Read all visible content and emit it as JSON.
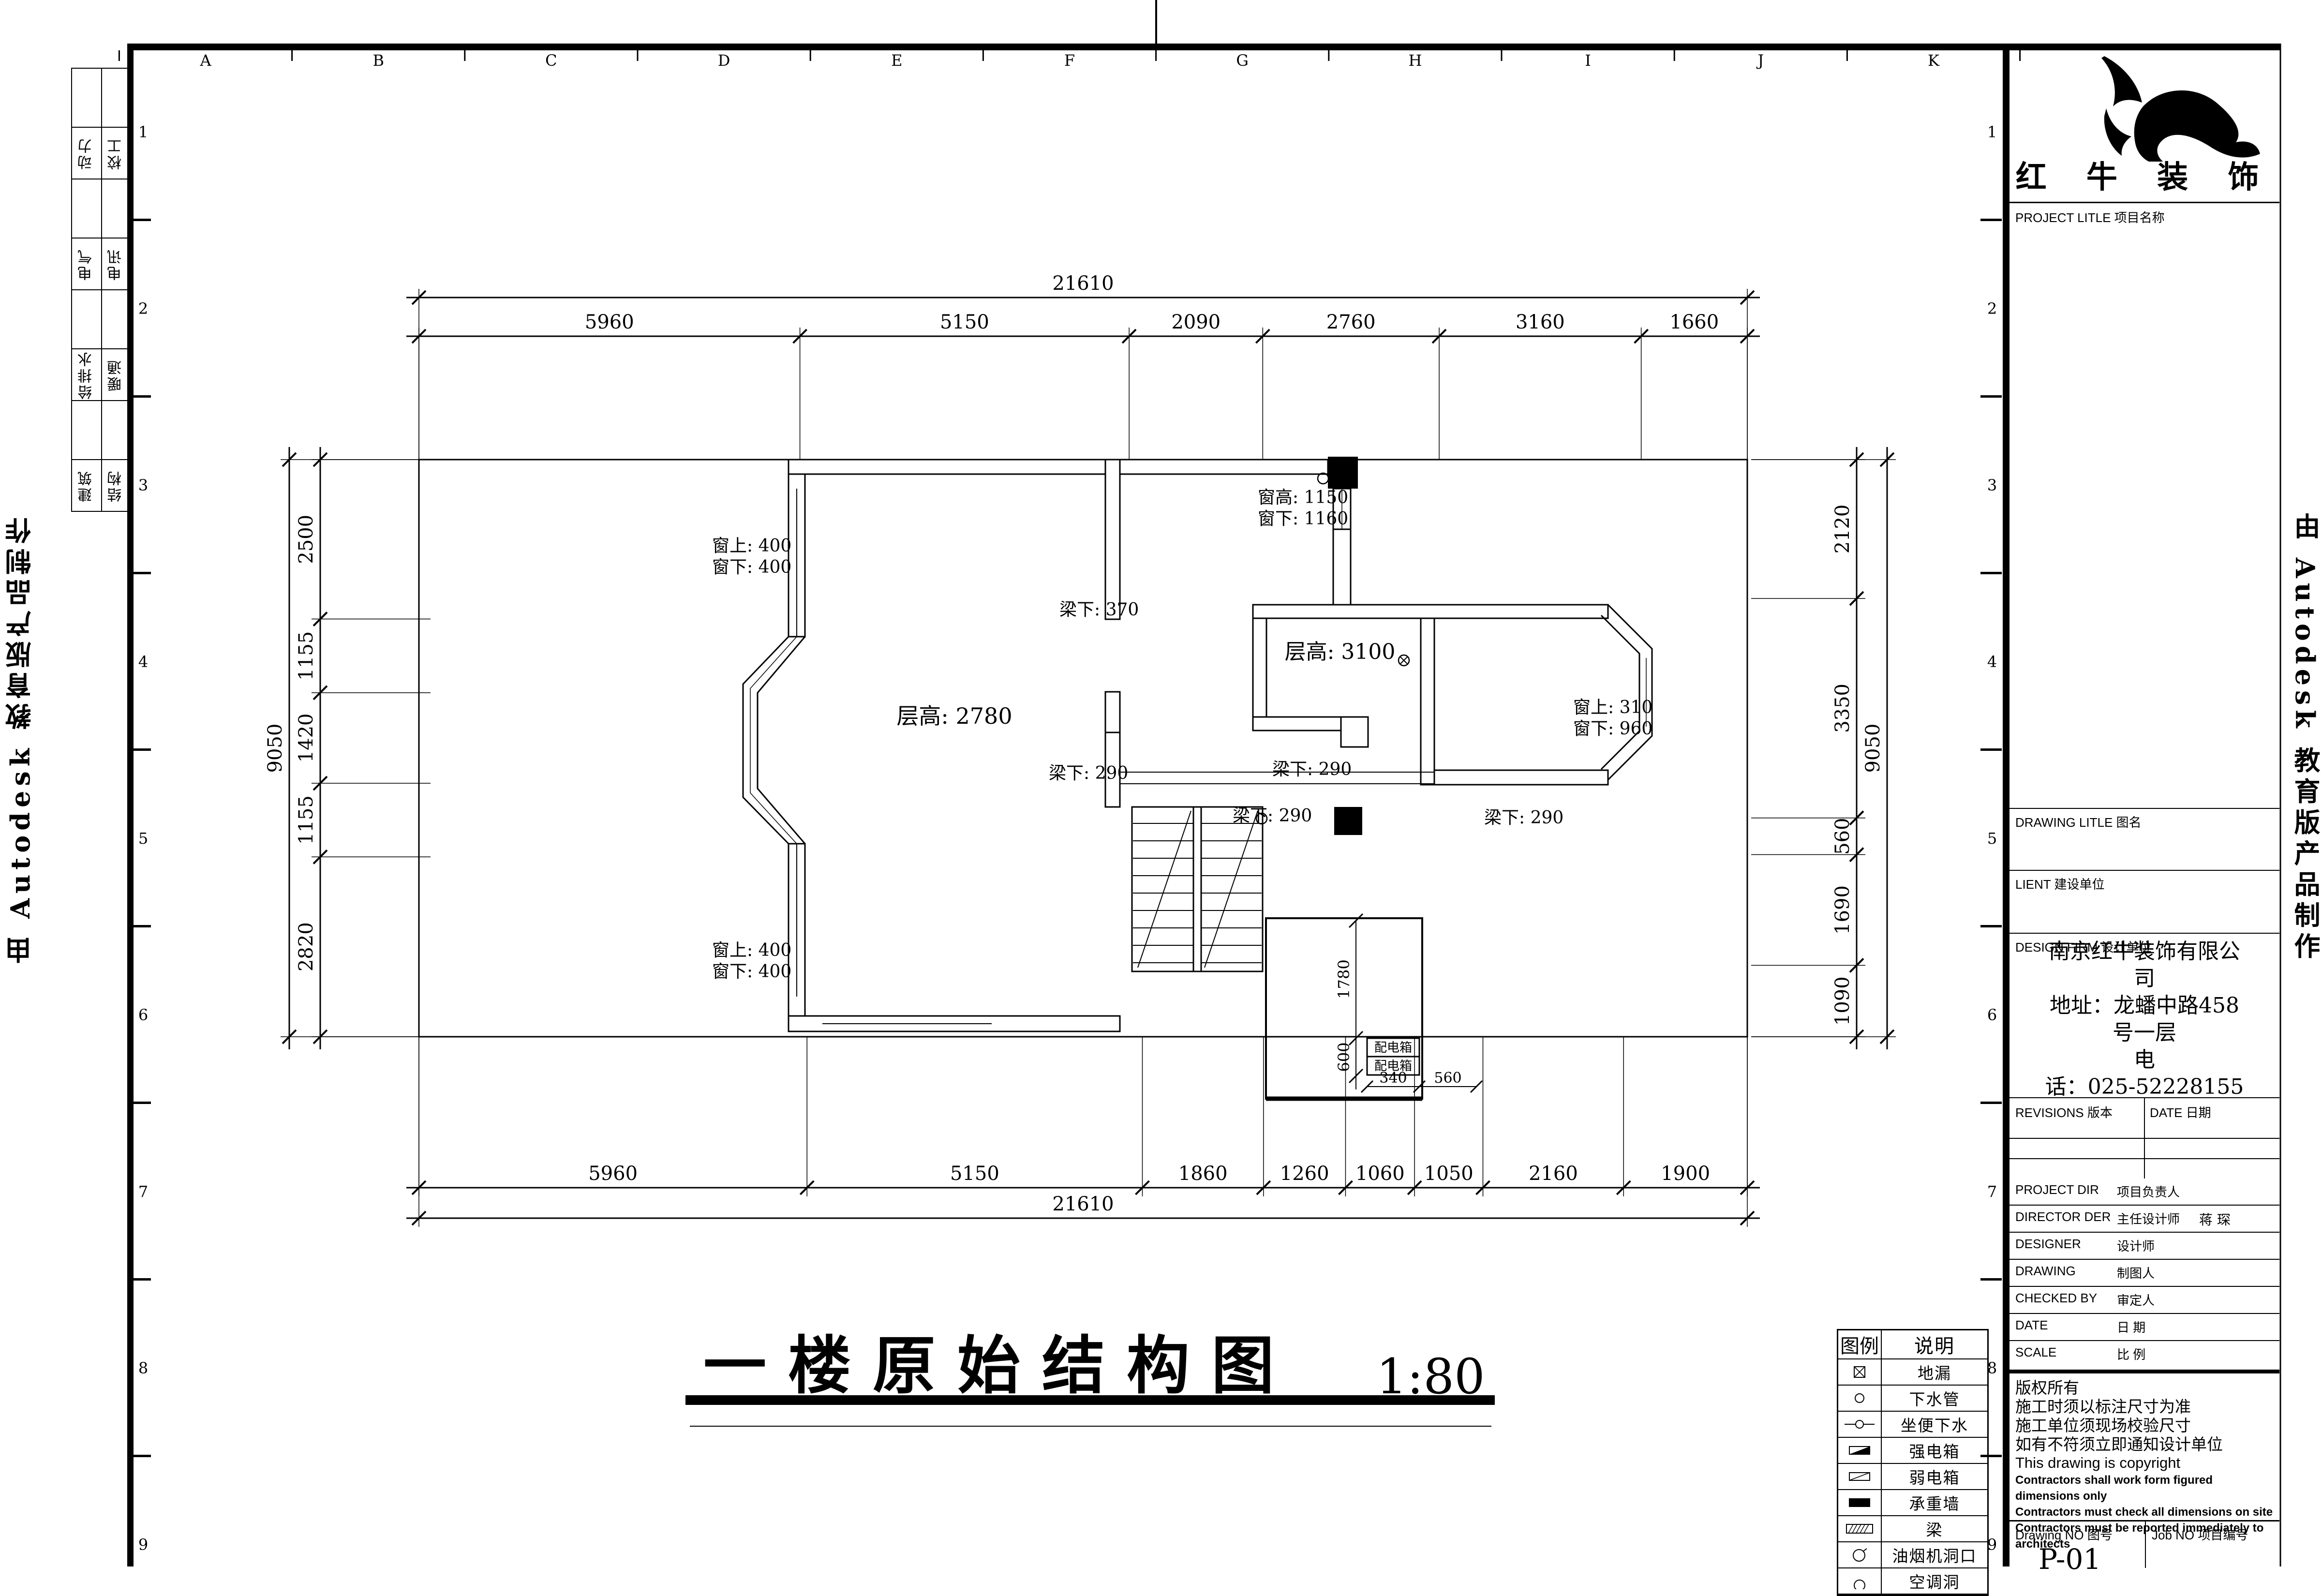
{
  "sheet": {
    "grid_letters": [
      "A",
      "B",
      "C",
      "D",
      "E",
      "F",
      "G",
      "H",
      "I",
      "J",
      "K"
    ],
    "grid_numbers": [
      "1",
      "2",
      "3",
      "4",
      "5",
      "6",
      "7",
      "8",
      "9"
    ],
    "edge_text": "由 Autodesk 教育版产品制作"
  },
  "title": {
    "text": "一楼原始结构图",
    "scale": "1:80"
  },
  "margin_table": {
    "rows": [
      [
        "动力",
        "校工"
      ],
      [
        "电气",
        "电讯"
      ],
      [
        "给排水",
        "暖通"
      ],
      [
        "建筑",
        "结构"
      ]
    ]
  },
  "dimensions": {
    "top_overall": "21610",
    "top_chain": [
      "5960",
      "5150",
      "2090",
      "2760",
      "3160",
      "1660"
    ],
    "bottom_chain": [
      "5960",
      "5150",
      "1860",
      "1260",
      "1060",
      "1050",
      "2160",
      "1900"
    ],
    "bottom_overall": "21610",
    "left_overall": "9050",
    "left_chain": [
      "2500",
      "1155",
      "1420",
      "1155",
      "2820"
    ],
    "right_chain": [
      "2120",
      "3350",
      "560",
      "1690",
      "1090"
    ],
    "right_overall": "9050",
    "shaft": {
      "v1": "1780",
      "v2": "600",
      "h1": "340",
      "h2": "560"
    }
  },
  "plan_labels": [
    "窗上: 400",
    "窗下: 400",
    "梁下: 370",
    "窗高: 1150",
    "窗下: 1160",
    "层高: 2780",
    "层高: 3100",
    "窗上: 310",
    "窗下: 960",
    "梁下: 290",
    "梁下: 290",
    "梁下: 290",
    "梁下: 290",
    "窗上: 400",
    "窗下: 400",
    "配电箱",
    "配电箱"
  ],
  "legend": {
    "headers": [
      "图例",
      "说明"
    ],
    "rows": [
      {
        "symbol": "floor-drain",
        "label": "地漏"
      },
      {
        "symbol": "drain-pipe",
        "label": "下水管"
      },
      {
        "symbol": "toilet-drain",
        "label": "坐便下水"
      },
      {
        "symbol": "strong-power-box",
        "label": "强电箱"
      },
      {
        "symbol": "weak-power-box",
        "label": "弱电箱"
      },
      {
        "symbol": "bearing-wall",
        "label": "承重墙"
      },
      {
        "symbol": "beam",
        "label": "梁"
      },
      {
        "symbol": "hood-opening",
        "label": "油烟机洞口"
      },
      {
        "symbol": "ac-hole",
        "label": "空调洞"
      }
    ]
  },
  "title_block": {
    "brand": "红 牛 装 饰",
    "project_label": "PROJECT LITLE  项目名称",
    "drawing_label": "DRAWING LITLE  图名",
    "client_label": "LIENT  建设单位",
    "design_firm_label": "DESIGN FIRM  设计单位",
    "firm_lines": [
      "南京红牛装饰有限公",
      "司",
      "地址：龙蟠中路458",
      "号一层",
      "电",
      "话：025-52228155"
    ],
    "revisions_label": "REVISIONS  版本",
    "revisions_date_label": "DATE  日期",
    "rows": [
      {
        "en": "PROJECT DIR",
        "cn": "项目负责人",
        "value": ""
      },
      {
        "en": "DIRECTOR DER",
        "cn": "主任设计师",
        "value": "蒋  琛"
      },
      {
        "en": "DESIGNER",
        "cn": "设计师",
        "value": ""
      },
      {
        "en": "DRAWING",
        "cn": "制图人",
        "value": ""
      },
      {
        "en": "CHECKED BY",
        "cn": "审定人",
        "value": ""
      },
      {
        "en": "DATE",
        "cn": "日  期",
        "value": ""
      },
      {
        "en": "SCALE",
        "cn": "比  例",
        "value": ""
      }
    ],
    "notes": [
      "版权所有",
      "施工时须以标注尺寸为准",
      "施工单位须现场校验尺寸",
      "如有不符须立即通知设计单位",
      "This drawing is copyright",
      "Contractors shall work form figured dimensions only",
      "Contractors must check all dimensions on site",
      "Contractors must be reported immediately to architects"
    ],
    "drawing_no_label": "Drawing NO  图号",
    "job_no_label": "Job NO  项目编号",
    "drawing_no": "P-01"
  }
}
